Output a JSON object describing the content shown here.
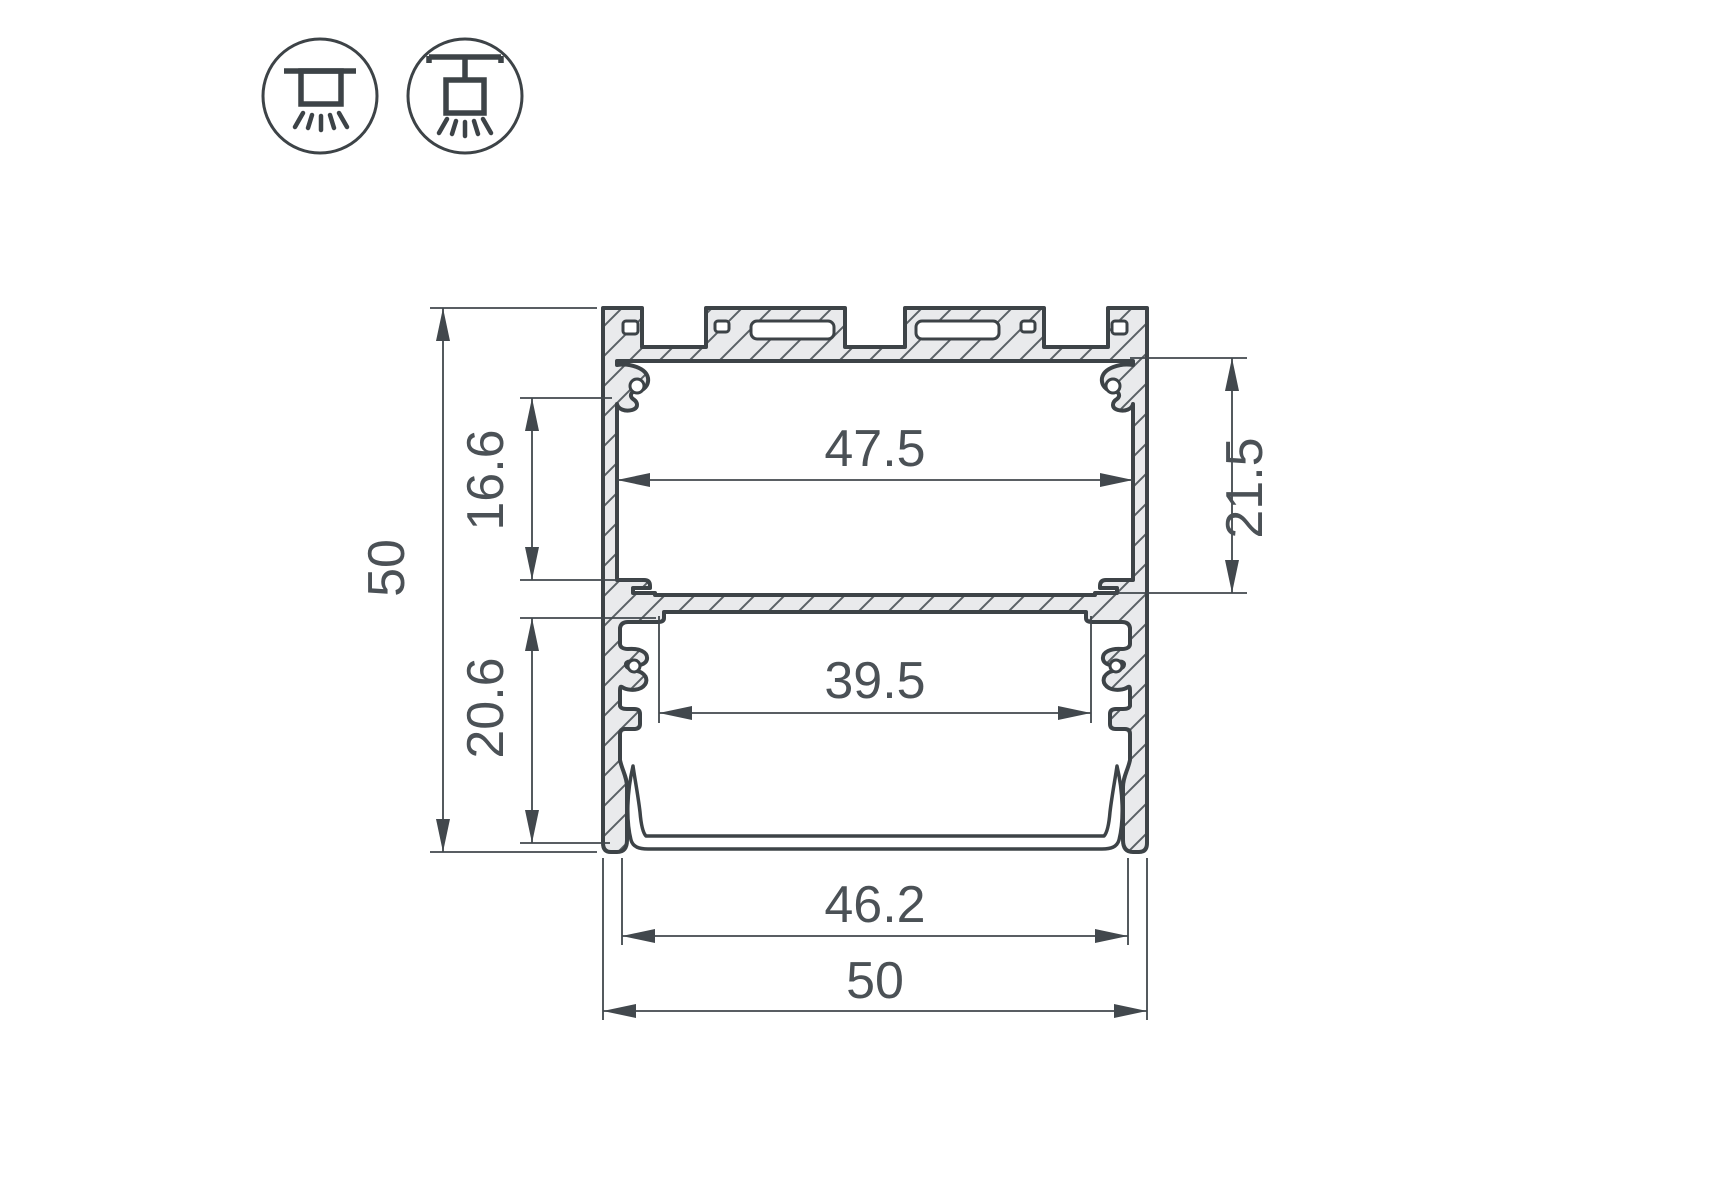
{
  "icons": {
    "left": "surface-mount-icon",
    "right": "pendant-mount-icon"
  },
  "dimensions": {
    "height_total": "50",
    "upper_cavity_left": "16.6",
    "lower_cavity_left": "20.6",
    "inner_width_top": "47.5",
    "upper_cavity_right": "21.5",
    "inner_width_bottom": "39.5",
    "diffuser_width": "46.2",
    "width_total": "50"
  },
  "colors": {
    "line": "#3d4347",
    "dim": "#42484d",
    "text": "#4b5156",
    "alfill": "#e9eaec",
    "hatch": "#5a6065",
    "bg": "#ffffff"
  }
}
